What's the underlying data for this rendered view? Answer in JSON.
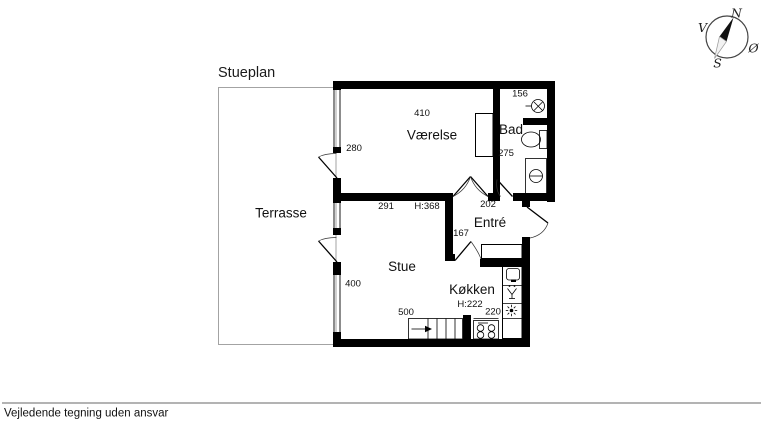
{
  "page": {
    "title": "Stueplan",
    "disclaimer": "Vejledende tegning uden ansvar"
  },
  "compass": {
    "north": "N",
    "east": "Ø",
    "south": "S",
    "west": "V"
  },
  "plan": {
    "rooms": {
      "terrasse": "Terrasse",
      "vaerelse": "Værelse",
      "bad": "Bad",
      "entre": "Entré",
      "stue": "Stue",
      "koekken": "Køkken"
    },
    "dims": {
      "vaerelse_width": "410",
      "vaerelse_window": "280",
      "vaerelse_depth": "275",
      "bad_width": "156",
      "entre_width": "202",
      "entre_depth": "167",
      "stue_top_width": "291",
      "stue_ceiling_height": "H:368",
      "stue_window": "400",
      "stue_bottom_width": "500",
      "koekken_ceiling_height": "H:222",
      "koekken_width": "220"
    },
    "colors": {
      "wall": "#000000",
      "terrasse_outline": "#a3a3a3",
      "divider_line": "#9a9a9a"
    }
  }
}
